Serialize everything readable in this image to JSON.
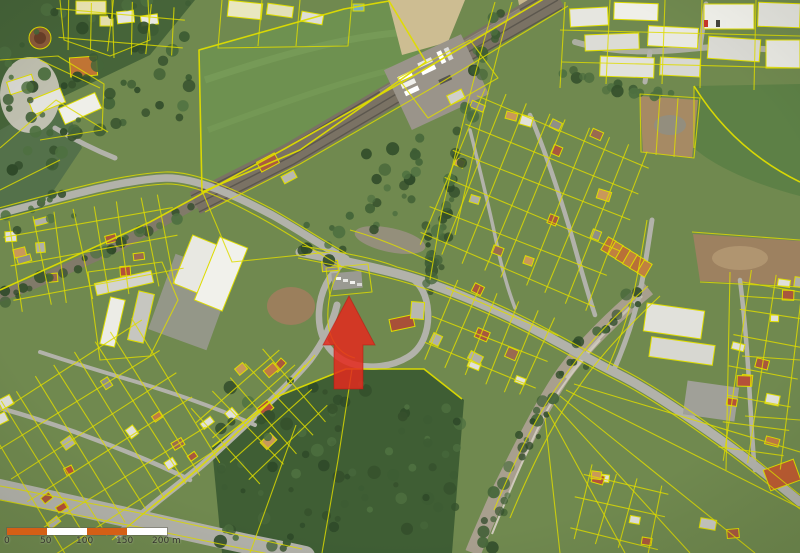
{
  "map": {
    "kind": "aerial-orthophoto-with-cadastre",
    "overlay": {
      "marker": {
        "icon": "red-arrow-up-icon",
        "color": "#e5291e",
        "tip_x": 349,
        "tip_y": 296
      },
      "parcel_line_color": "#dedc00"
    },
    "scale_bar": {
      "labels": [
        "0",
        "50",
        "100",
        "150",
        "200 m"
      ],
      "tick_values": [
        0,
        50,
        100,
        150,
        200
      ],
      "unit": "m",
      "segment_colors": [
        "#d45f16",
        "#ffffff",
        "#d45f16",
        "#ffffff"
      ],
      "text_color": "#35352c"
    },
    "palette": {
      "grass_green": "#70894f",
      "field_green": "#6e9150",
      "forest_green": "#3f5e34",
      "road_gray": "#b2b2aa",
      "rail_gray": "#7a7264",
      "bare_soil": "#a68a64",
      "tan_field": "#cdbd92",
      "building_white": "#e9e9e3",
      "stream_gravel": "#a89f8e"
    }
  }
}
